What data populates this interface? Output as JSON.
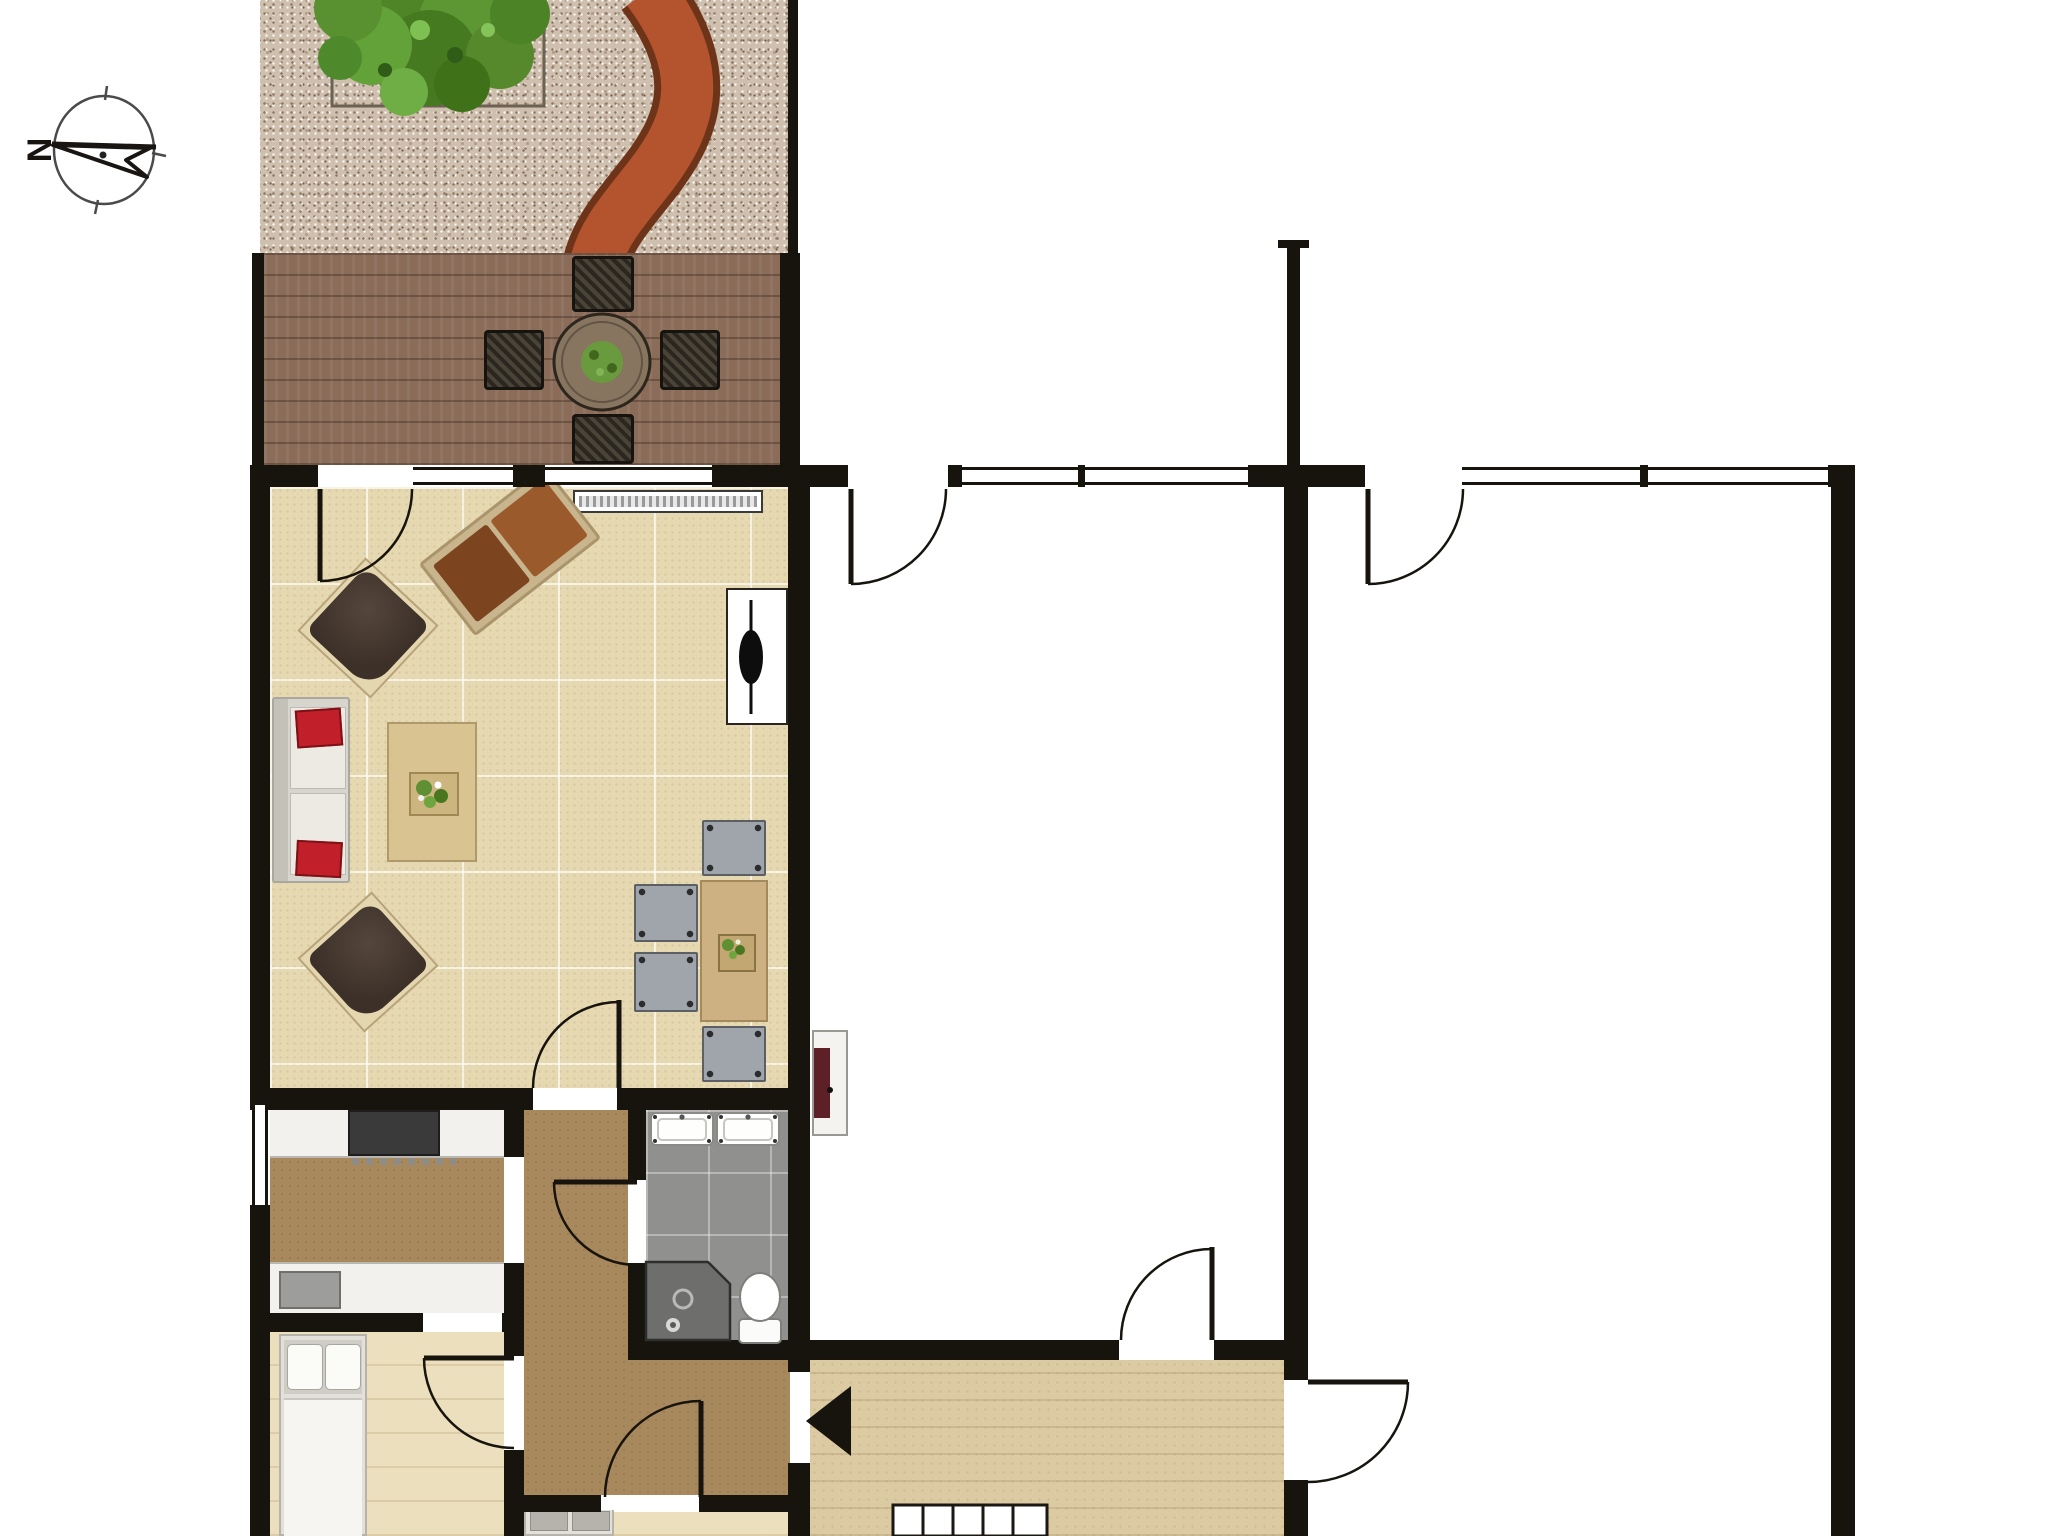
{
  "title": "ground-floor plan with garden, terrace and stair hall",
  "compass": {
    "label": "N",
    "needle_points": "left"
  },
  "palette": {
    "paper": "#ffffff",
    "wall": "#17130d",
    "garden": "#cfbfae",
    "deck": "#8a6c59",
    "floorLiving": "#e6d9b2",
    "kitchenHall": "#a8895d",
    "bathFloor": "#90908e",
    "bedroomFloor": "#ecdfbe",
    "stairHall": "#dccaa3",
    "path": "#b4542e",
    "pathEdge": "#6e3419",
    "tree": "#568f2d",
    "accentRed": "#c1202b",
    "chairDark": "#43362e",
    "loungeBrown": "#8c4f22",
    "tableWood": "#cdb183",
    "grayChair": "#a0a5ab"
  },
  "rooms": [
    {
      "id": "garden",
      "name": "gravel garden",
      "features": [
        "tree in square planter",
        "curved red brick path"
      ]
    },
    {
      "id": "terrace",
      "name": "wooden deck terrace",
      "features": [
        "round table with plant",
        "4 wicker chairs"
      ]
    },
    {
      "id": "living-room",
      "name": "living room",
      "features": [
        "sofa with 2 red cushions",
        "2 dark armchairs",
        "lounge recliner",
        "coffee table with plant",
        "dining table with plant and 4 grey chairs",
        "radiator",
        "wall tv"
      ]
    },
    {
      "id": "kitchen",
      "name": "kitchen",
      "features": [
        "counter with 4-burner stove",
        "counter with sink",
        "side window"
      ]
    },
    {
      "id": "hallway",
      "name": "hallway",
      "features": []
    },
    {
      "id": "bathroom",
      "name": "bathroom",
      "features": [
        "double sink",
        "shower",
        "toilet"
      ]
    },
    {
      "id": "bedroom-1",
      "name": "bedroom (bottom left)",
      "features": [
        "single bed"
      ]
    },
    {
      "id": "bedroom-2",
      "name": "bedroom (bottom, partly cut off)",
      "features": [
        "single bed"
      ]
    },
    {
      "id": "stair-hall",
      "name": "entrance / stair hall",
      "features": [
        "staircase",
        "direction arrow pointing left"
      ]
    },
    {
      "id": "room-middle",
      "name": "unfurnished middle room",
      "features": [
        "wall stove / fireplace with red front"
      ]
    },
    {
      "id": "room-right",
      "name": "unfurnished right room",
      "features": []
    }
  ],
  "doors": [
    {
      "from": "terrace",
      "to": "living-room"
    },
    {
      "from": "living-room",
      "to": "hallway"
    },
    {
      "from": "hallway",
      "to": "bathroom"
    },
    {
      "from": "hallway",
      "to": "bedroom-1"
    },
    {
      "from": "kitchen",
      "to": "hallway",
      "type": "opening"
    },
    {
      "from": "outside-north",
      "to": "room-middle"
    },
    {
      "from": "outside-north",
      "to": "room-right"
    },
    {
      "from": "stair-hall",
      "to": "room-middle"
    },
    {
      "from": "stair-hall",
      "to": "room-right"
    },
    {
      "from": "hallway",
      "to": "stair-hall",
      "type": "opening"
    },
    {
      "from": "hallway",
      "to": "bedroom-2"
    }
  ],
  "windows_count": 7
}
